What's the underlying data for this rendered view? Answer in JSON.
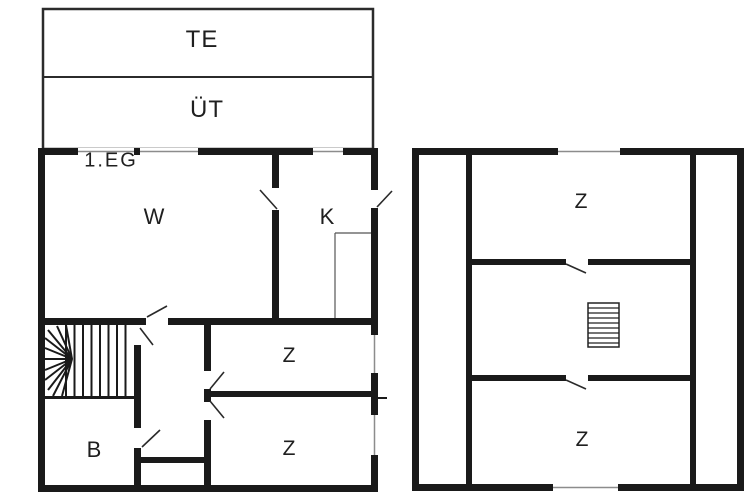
{
  "document": {
    "type": "floor-plan",
    "floor_label": "1.EG"
  },
  "annex": {
    "rows": [
      {
        "label": "TE"
      },
      {
        "label": "ÜT"
      }
    ]
  },
  "left_plan": {
    "floor_label": "1.EG",
    "rooms": [
      {
        "name": "room-w",
        "label": "W"
      },
      {
        "name": "room-k",
        "label": "K"
      },
      {
        "name": "room-z-upper",
        "label": "Z"
      },
      {
        "name": "room-z-lower",
        "label": "Z"
      },
      {
        "name": "room-b",
        "label": "B"
      }
    ],
    "features": [
      "winder-staircase",
      "kitchen-counter",
      "exterior-door",
      "windows"
    ]
  },
  "right_plan": {
    "rooms": [
      {
        "name": "room-z-top",
        "label": "Z"
      },
      {
        "name": "room-z-bottom",
        "label": "Z"
      }
    ],
    "features": [
      "straight-staircase",
      "windows"
    ]
  },
  "colors": {
    "background": "#ffffff",
    "wall": "#1a1a1a",
    "annex_border": "#2b2b2b",
    "window_mullion": "#8c8c8c",
    "door_leaf": "#2a2a2a"
  }
}
